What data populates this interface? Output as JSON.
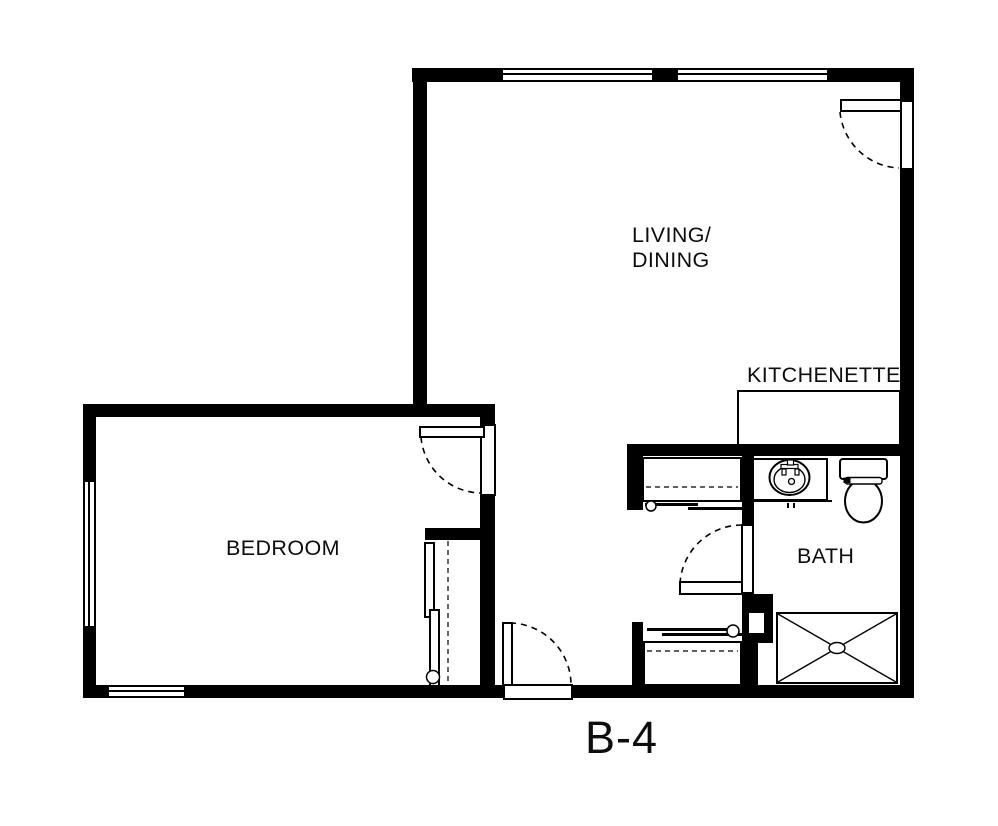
{
  "floor_plan": {
    "unit_label": "B-4",
    "rooms": {
      "living_dining": {
        "label_line1": "LIVING/",
        "label_line2": "DINING"
      },
      "kitchenette": {
        "label": "KITCHENETTE"
      },
      "bedroom": {
        "label": "BEDROOM"
      },
      "bath": {
        "label": "BATH"
      }
    },
    "features": {
      "doors": [
        "entry-door",
        "bedroom-door",
        "bath-door",
        "hall-exterior-door"
      ],
      "closets": [
        "hall-closet",
        "linen-closet",
        "bedroom-closet"
      ],
      "fixtures": [
        "bathroom-sink",
        "toilet",
        "shower",
        "kitchenette-counter"
      ],
      "windows": [
        "living-window-1",
        "living-window-2",
        "bedroom-west-window",
        "bedroom-south-window"
      ]
    },
    "colors": {
      "wall": "#000000",
      "line": "#000000",
      "background": "#ffffff",
      "text": "#0d0d0d"
    }
  }
}
